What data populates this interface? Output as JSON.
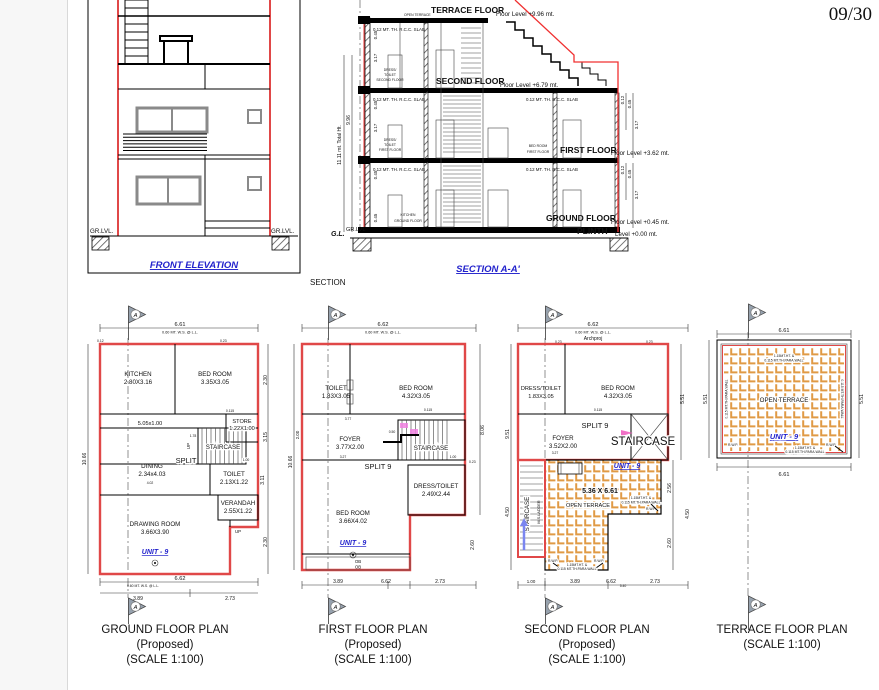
{
  "page": {
    "number": "09/30"
  },
  "flags": {
    "letter": "A"
  },
  "colors": {
    "wall_red": "#e04848",
    "label_blue": "#2222cc",
    "tile_orange": "#e09a45"
  },
  "elevation": {
    "title": "FRONT ELEVATION",
    "caption": "SECTION",
    "gr_lvl_left": "GR.LVL.",
    "gr_lvl_right": "GR.LVL."
  },
  "section": {
    "title": "SECTION A-A'",
    "terrace_floor": "TERRACE FLOOR",
    "terrace_level": "Floor Level +9.96 mt.",
    "open_terrace": "OPEN TERRACE",
    "slab": "0.12 MT. TH. R.C.C. SLAB",
    "second_floor": "SECOND FLOOR",
    "second_level": "Floor Level +6.79 mt.",
    "first_floor": "FIRST FLOOR",
    "first_level": "Floor Level +3.62 mt.",
    "ground_floor": "GROUND FLOOR",
    "ground_level": "Floor Level +0.45 mt.",
    "plinth": "PLINTH",
    "plinth_level": "Level +0.00 mt.",
    "dress_toilet_second": [
      "DRESS/",
      "TOILET",
      "SECOND FLOOR"
    ],
    "dress_toilet_first": [
      "DRESS/",
      "TOILET",
      "FIRST FLOOR"
    ],
    "bed_room_first": [
      "BED ROOM",
      "FIRST FLOOR"
    ],
    "kitchen_ground": [
      "KITCHEN",
      "GROUND FLOOR"
    ],
    "total_ht": "11.11 mt. Total Ht.",
    "ht_996": "9.96",
    "gl": "G.L.",
    "gr_lvl": "GR.LVL",
    "d317": "3.17",
    "d045": "0.45",
    "d012": "0.12"
  },
  "ground": {
    "title": "GROUND FLOOR PLAN",
    "subtitle": "(Proposed)",
    "scale": "(SCALE 1:100)",
    "unit": "UNIT - 9",
    "dim_top": "6.61",
    "wall_note": "0.60 MT. W.S. @ L.L.",
    "kitchen": "KITCHEN",
    "kitchen_size": "2.80X3.16",
    "bedroom": "BED ROOM",
    "bedroom_size": "3.35X3.05",
    "passage": "5.05x1.00",
    "store": "STORE",
    "store_size": "1.22X1.00",
    "staircase": "STAIRCASE",
    "split": "SPLIT",
    "up": "UP",
    "dining": "DINING",
    "dining_size": "2.34x4.03",
    "toilet": "TOILET",
    "toilet_size": "2.13X1.22",
    "verandah": "VERANDAH",
    "verandah_size": "2.55X1.22",
    "drawing_room": "DRAWING ROOM",
    "drawing_room_size": "3.66X3.90",
    "d_left": "10.66",
    "d_r1": "2.30",
    "d_r2": "3.15",
    "d_r3": "3.11",
    "d_r4": "2.30",
    "d_bottom": "6.62",
    "d_b1": "3.89",
    "d_b2": "2.73",
    "d_178": "1.78",
    "d_100": "1.00",
    "d_115": "0.115",
    "d_402": "4.02",
    "d_012": "0.12",
    "d_023": "0.23"
  },
  "first": {
    "title": "FIRST FLOOR PLAN",
    "subtitle": "(Proposed)",
    "scale": "(SCALE 1:100)",
    "unit": "UNIT - 9",
    "dim_top": "6.62",
    "wall_note": "0.60 MT. W.S. @ L.L.",
    "toilet": "TOILET",
    "toilet_size": "1.83X3.05",
    "bedroom1": "BED ROOM",
    "bedroom1_size": "4.32X3.05",
    "foyer": "FOYER",
    "foyer_size": "3.77X2.00",
    "staircase": "STAIRCASE",
    "split": "SPLIT 9",
    "dress": "DRESS/TOILET",
    "dress_size": "2.49X2.44",
    "bedroom2": "BED ROOM",
    "bedroom2_size": "3.66X4.02",
    "ob": "OB",
    "d_left": "10.66",
    "d_200": "2.00",
    "d_right": "8.06",
    "d_023": "0.23",
    "d_260": "2.60",
    "d_b1": "3.89",
    "d_bottom": "6.62",
    "d_b2": "2.73",
    "d_377": "3.77",
    "d_327": "3.27",
    "d_050": "0.50",
    "d_115": "0.115",
    "d_100": "1.00"
  },
  "second": {
    "title": "SECOND FLOOR PLAN",
    "subtitle": "(Proposed)",
    "scale": "(SCALE 1:100)",
    "unit": "UNIT - 9",
    "watermark": "Archproj",
    "dim_top": "6.62",
    "wall_note": "0.60 MT. W.S. @ L.L.",
    "dress": "DRESS/TOILET",
    "dress_size": "1.83X3.05",
    "bedroom": "BED ROOM",
    "bedroom_size": "4.32X3.05",
    "split": "SPLIT 9",
    "foyer": "FOYER",
    "foyer_size": "3.52X2.00",
    "staircase": "STAIRCASE",
    "staircase_side": "STAIRCASE",
    "ladder": "M.S.LADDER",
    "terrace_size": "5.36 X 6.61",
    "open_terrace": "OPEN TERRACE",
    "para1": "1.15MT.HT. &",
    "para2": "0.115 MT.TH.PARA WALL",
    "rwp": "R.W.P.",
    "d_l1": "9.51",
    "d_l2": "4.50",
    "d_r1": "5.51",
    "d_r2": "2.56",
    "d_r3": "4.50",
    "d_r4": "2.60",
    "d_b0": "1.00",
    "d_b1": "3.89",
    "d_bottom": "6.62",
    "d_b540": "5.40",
    "d_b2": "2.73",
    "d_023": "0.23",
    "d_327": "3.27",
    "d_115": "0.115"
  },
  "terrace": {
    "title": "TERRACE FLOOR PLAN",
    "scale": "(SCALE 1:100)",
    "unit": "UNIT - 9",
    "open_terrace": "OPEN TERRACE",
    "dim_top": "6.61",
    "dim_bottom": "6.61",
    "d_left": "5.51",
    "d_right": "5.51",
    "para1": "1.15MT.HT. &",
    "para2": "0.115 MT.TH.PARA.WALL",
    "rwp": "R.W.P."
  }
}
